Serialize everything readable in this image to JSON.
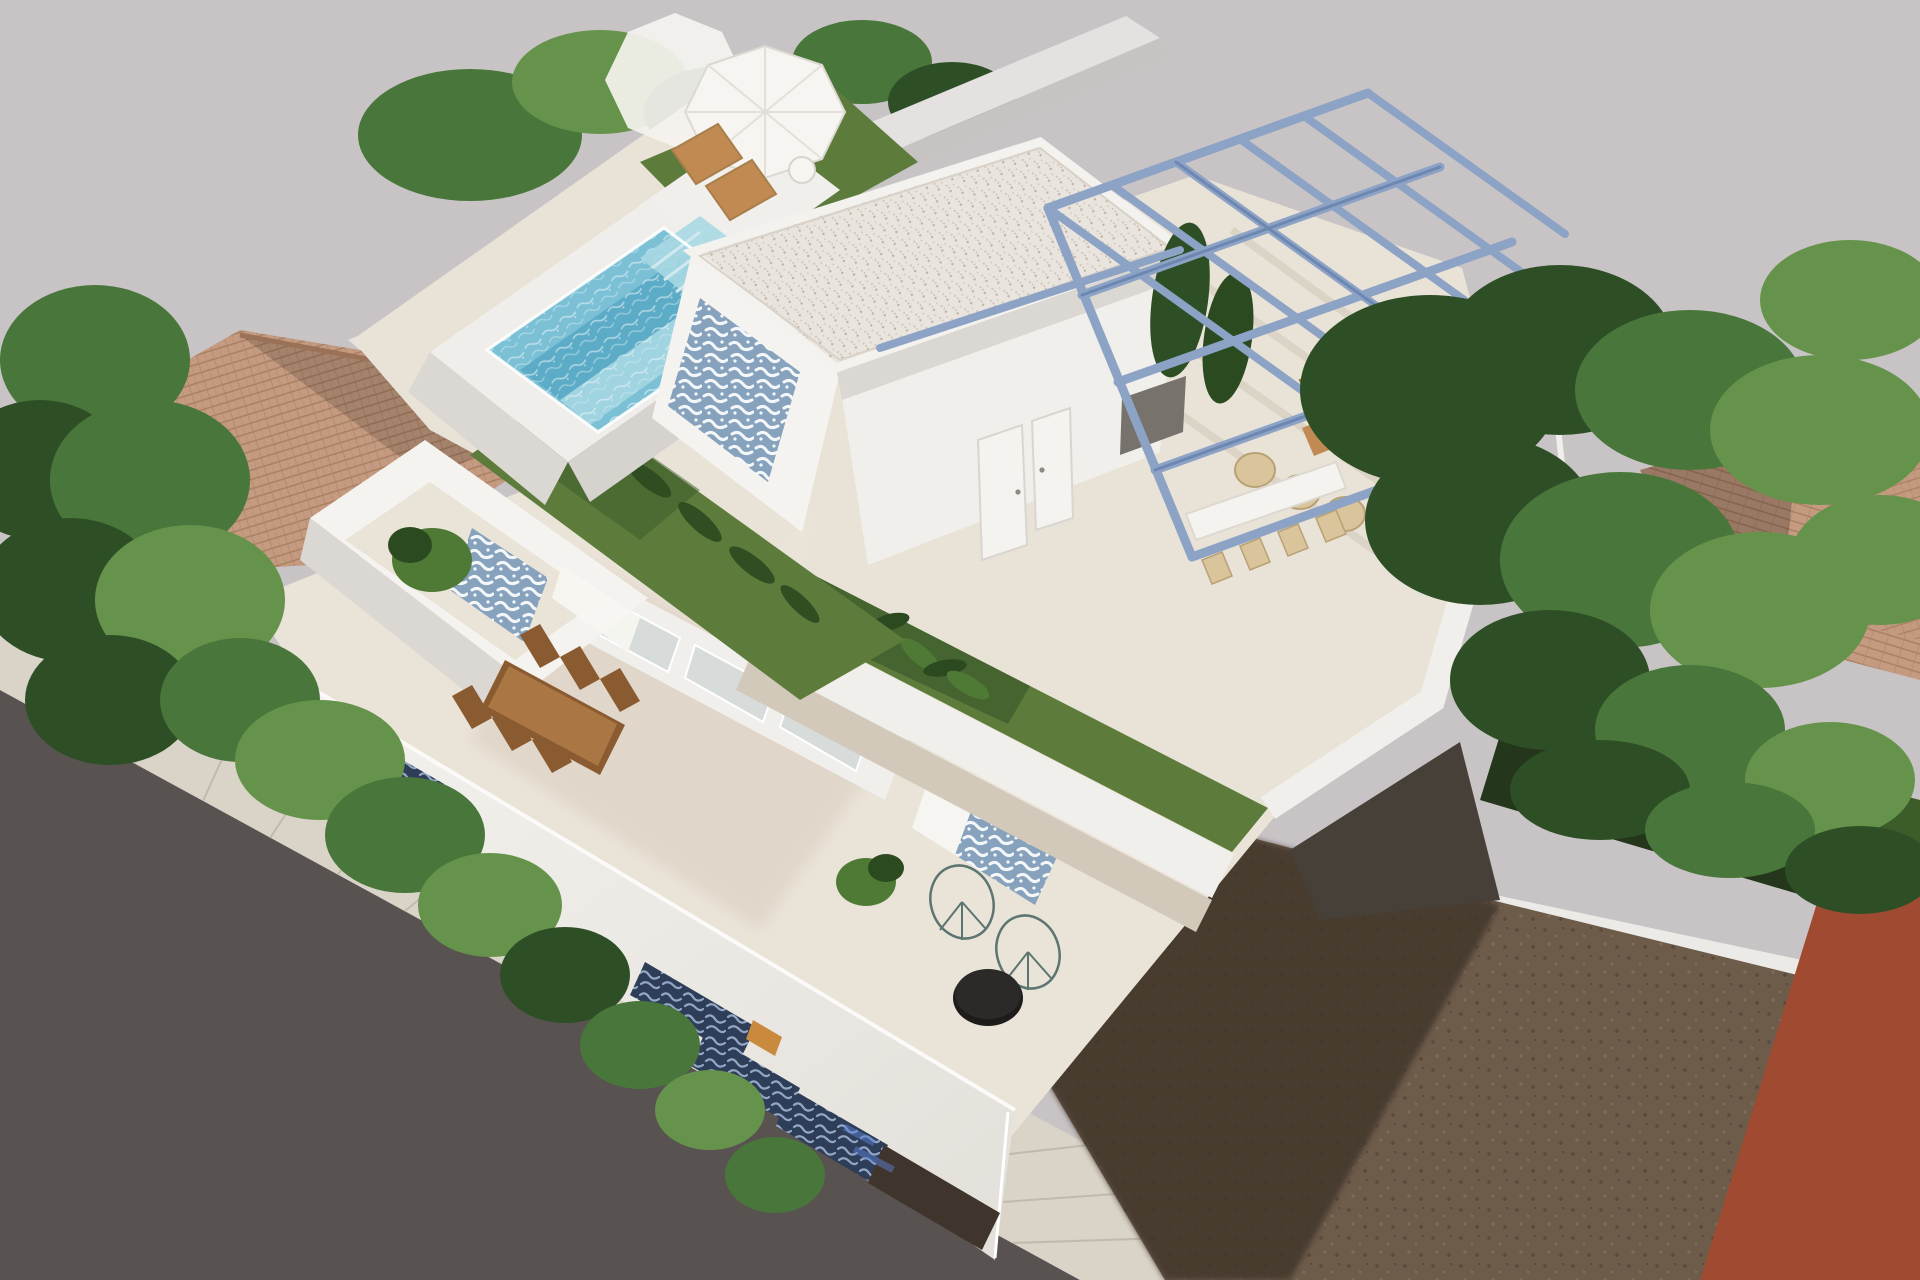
{
  "scene": {
    "kind": "3D architectural rendering",
    "view": "aerial oblique (bird's eye) view",
    "description": "Modern two-storey white villa with rooftop swimming pool, artificial grass roof garden, white pavilion with gravel flat roof, steel-blue pergola over a roof dining terrace, cut-away first floor terrace with wooden dining table and acapulco chairs, ornamental blue tile accents, surrounded by neighbouring terracotta roofs, trees, a street with sidewalk and an empty dirt plot next to an orange building"
  },
  "objects": {
    "villa": [
      "rooftop-pool",
      "pool-steps",
      "sun-loungers",
      "parasols",
      "roof-turf",
      "roof-pavilion",
      "gravel-flat-roof",
      "blue-tile-accent-walls",
      "pavilion-doors",
      "steel-pergola",
      "roof-dining-table",
      "wicker-lounge-chairs",
      "roof-long-table",
      "banana-plants",
      "first-floor-terrace",
      "wooden-dining-table",
      "sliding-glass-doors",
      "curtains",
      "balcony-planter",
      "acapulco-chairs",
      "black-coffee-table",
      "street-parapet-with-tile-openings",
      "facade-watermark"
    ],
    "surroundings": [
      "gray-backdrop",
      "asphalt-road",
      "paved-sidewalk",
      "left-terracotta-roof",
      "right-terracotta-roof",
      "boundary-wall",
      "left-trees",
      "right-trees",
      "hedges",
      "shaded-lawn",
      "white-garden-wall",
      "dirt-plot",
      "building-shadow",
      "orange-building"
    ]
  },
  "palette": {
    "bg": "#c8c4c5",
    "road": "#585251",
    "sidewalk": "#d9d3c8",
    "sidewalk-line": "#b9b1a4",
    "wall-white": "#f5f3ef",
    "wall-lit": "#f1efeb",
    "wall-shadow": "#dbd7d2",
    "wall-edge": "#c7c3c2",
    "backwall": "#e4e1e0",
    "roof-floor": "#e9e3d7",
    "floor-shadow": "#d2c9bb",
    "terrace-floor": "#eae3d7",
    "terrace-shadow": "#d8cec0",
    "grass": "#5d7c3c",
    "grass-dark": "#3c5a2a",
    "grass-bright": "#6f9348",
    "pool-curb": "#f0eeea",
    "pool-face": "#d6d2cd",
    "water": "#7cc0d6",
    "water-deep": "#58a8c4",
    "water-light": "#a9d8e3",
    "gravel": "#e9e4dd",
    "gravel-dot": "#cfc7bb",
    "gravel-dot2": "#bdb3a4",
    "tile-blue": "#87a2bc",
    "tile-mark": "#f4f7fa",
    "tile-navy": "#2e3d58",
    "tile-navy-mark": "#93a7c4",
    "pergola": "#8ca3c6",
    "pergola-dark": "#6d87b0",
    "wood": "#c08a52",
    "wood-dark": "#8a5a30",
    "wood-edge": "#6f4423",
    "wicker": "#d9c49c",
    "wicker-dark": "#b9a176",
    "curtain": "#f7f5f1",
    "glass": "#d7dcda",
    "terracotta": "#c49b80",
    "terracotta-line": "#a87e62",
    "terracotta-shade": "#9b7258",
    "dirt": "#6e5c4b",
    "dirt-shadow": "#3f352c",
    "dirt-dot": "#55463a",
    "dirt-dot2": "#84705c",
    "orange-wall": "#a04a31",
    "orange-dark": "#7e3a26",
    "black-table": "#1d1c1b",
    "plant": "#4e7a35",
    "plant-dark": "#2c4a1f",
    "amber": "#c98a3e",
    "watermark": "#5b7fd4",
    "tree-dark": "#2e4f26",
    "tree-mid": "#49763a",
    "tree-light": "#66934b",
    "lawn-dark": "#24371c",
    "lawn": "#3c5c2a",
    "wallstrip": "#eceae6",
    "niche": "#77726c",
    "shadow-wall": "#474038"
  }
}
